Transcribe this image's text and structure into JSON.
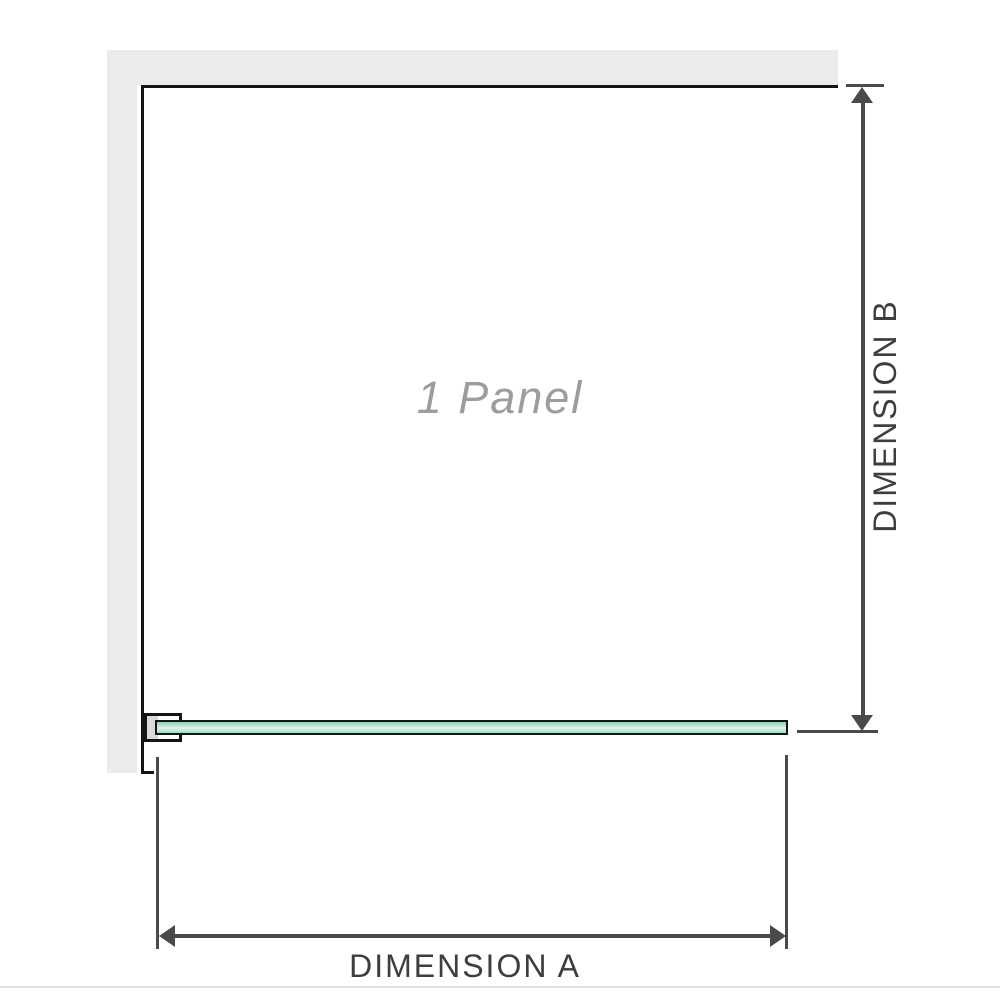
{
  "diagram": {
    "panel": {
      "label": "1 Panel"
    },
    "dimensions": {
      "a": {
        "label": "DIMENSION A",
        "orientation": "horizontal"
      },
      "b": {
        "label": "DIMENSION B",
        "orientation": "vertical"
      }
    },
    "colors": {
      "wall": "#ebebeb",
      "outline": "#141414",
      "dimension_line": "#4a4a4a",
      "dimension_text": "#3e3e3e",
      "panel_text": "#9d9d9d",
      "glass_top": "#8ccfab",
      "glass_mid": "#ddf2e7",
      "glass_bottom": "#a9dcc3",
      "bracket_fill": "#ffffff",
      "bracket_inner": "#d9d9d9",
      "footer_rule": "#e4e1db"
    }
  }
}
